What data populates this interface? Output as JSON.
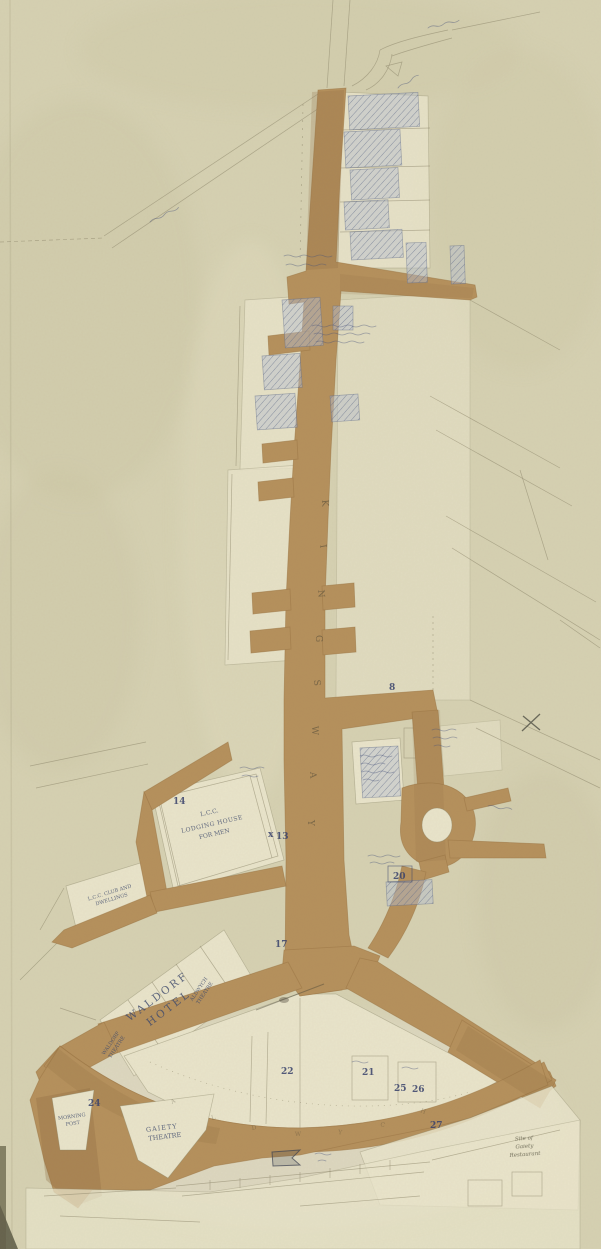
{
  "map": {
    "street_letters": [
      "K",
      "I",
      "N",
      "G",
      "S",
      "W",
      "A",
      "Y"
    ],
    "crescent_letters": [
      "A",
      "L",
      "D",
      "W",
      "Y",
      "C",
      "H"
    ],
    "labels": {
      "waldorf_hotel": [
        "WALDORF",
        "HOTEL"
      ],
      "waldorf_theatre": [
        "WALDORF",
        "THEATRE"
      ],
      "aldwych_theatre": [
        "ALDWYCH",
        "THEATRE"
      ],
      "gaiety_theatre": [
        "GAIETY",
        "THEATRE"
      ],
      "morning_post": [
        "MORNING",
        "POST"
      ],
      "lcc_lodging_house": [
        "L.C.C.",
        "LODGING HOUSE",
        "FOR MEN"
      ],
      "lcc_dwellings": [
        "L.C.C. CLUB AND",
        "DWELLINGS"
      ],
      "site_note": [
        "Site of",
        "Gaiety",
        "Restaurant"
      ],
      "x13_prefix": "x"
    },
    "plot_numbers": [
      "8",
      "13",
      "14",
      "17",
      "20",
      "21",
      "22",
      "24",
      "25",
      "26",
      "27"
    ],
    "colors": {
      "paper": "#d6d1b2",
      "street_tan": "#b5905c",
      "plot_cream": "#e9e4ca",
      "hatch_blue": "#8f9ab5",
      "ink_blue": "#3e4a6d"
    }
  }
}
